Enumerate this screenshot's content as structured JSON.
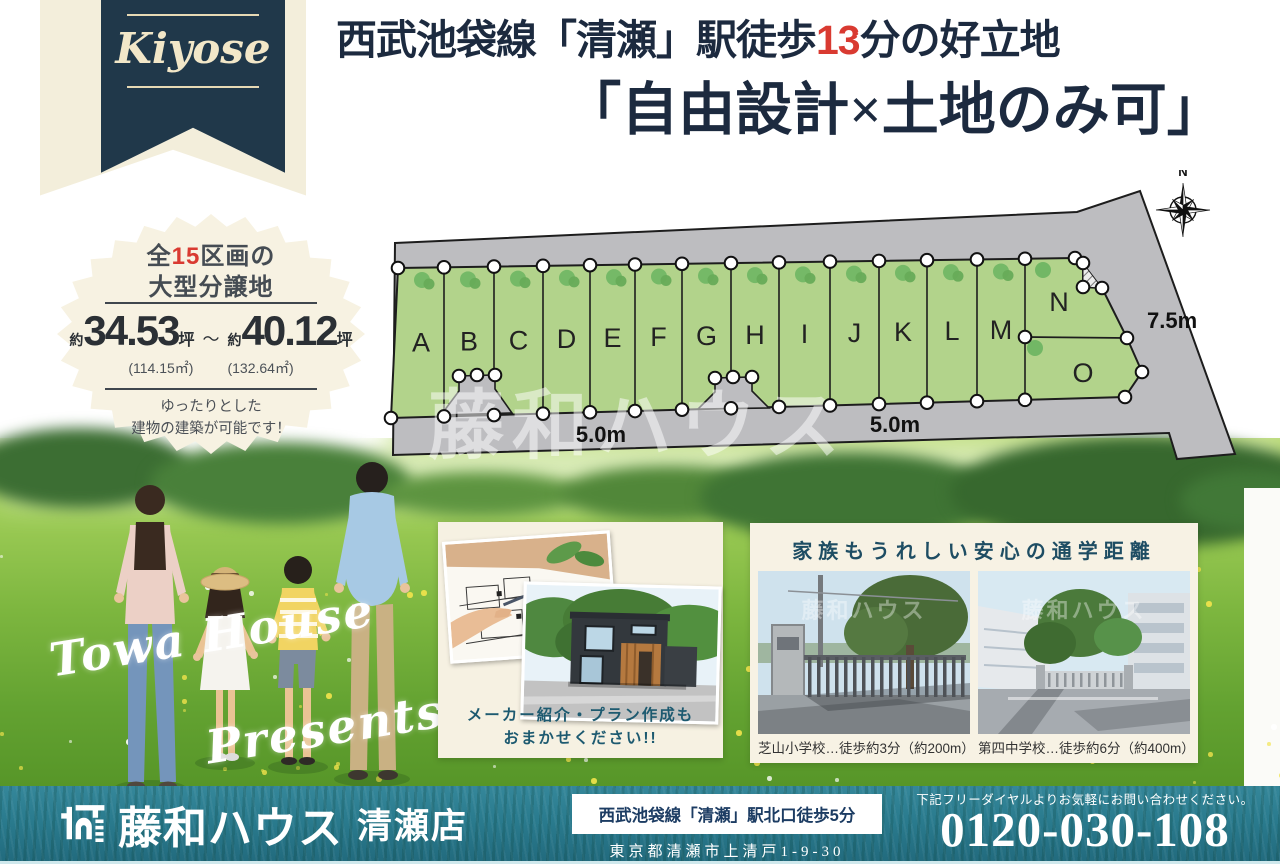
{
  "watermark": "藤和ハウス",
  "ribbon": {
    "label": "Kiyose"
  },
  "headline": {
    "line1_before": "西武池袋線「清瀬」駅徒歩",
    "line1_highlight": "13",
    "line1_after": "分の好立地",
    "line2": "「自由設計×土地のみ可」"
  },
  "badge": {
    "count_before": "全",
    "count": "15",
    "count_after": "区画の",
    "line2": "大型分譲地",
    "approx1": "約",
    "size_min": "34.53",
    "unit1": "坪",
    "tilde": "～",
    "approx2": "約",
    "size_max": "40.12",
    "unit2": "坪",
    "size_min_m2": "(114.15㎡)",
    "size_max_m2": "(132.64㎡)",
    "note_line1": "ゆったりとした",
    "note_line2": "建物の建築が可能です！"
  },
  "map": {
    "lots": [
      "A",
      "B",
      "C",
      "D",
      "E",
      "F",
      "G",
      "H",
      "I",
      "J",
      "K",
      "L",
      "M"
    ],
    "lot_n": "N",
    "lot_o": "O",
    "dim_bottom_left": "5.0m",
    "dim_bottom_right": "5.0m",
    "dim_right": "7.5m",
    "compass": "N"
  },
  "field": {
    "script_line1": "Towa House",
    "script_line2": "Presents"
  },
  "plan_card": {
    "caption_line1": "メーカー紹介・プラン作成も",
    "caption_line2": "おまかせください!!"
  },
  "school_card": {
    "title": "家族もうれしい安心の通学距離",
    "captions": [
      "芝山小学校…徒歩約3分（約200m）",
      "第四中学校…徒歩約6分（約400m）"
    ]
  },
  "footer": {
    "brand": "藤和ハウス",
    "branch": "清瀬店",
    "access": "西武池袋線「清瀬」駅北口徒歩5分",
    "address": "東京都清瀬市上清戸1-9-30",
    "note": "下記フリーダイヤルよりお気軽にお問い合わせください。",
    "phone": "0120-030-108"
  },
  "colors": {
    "navy": "#1c2a3f",
    "ribbon_navy": "#20384a",
    "cream": "#f6f1e2",
    "accent_red": "#d93a31",
    "lot_green": "#b2d38b",
    "road_gray": "#bdbdc0",
    "footer_teal": "#2a7b8e"
  }
}
